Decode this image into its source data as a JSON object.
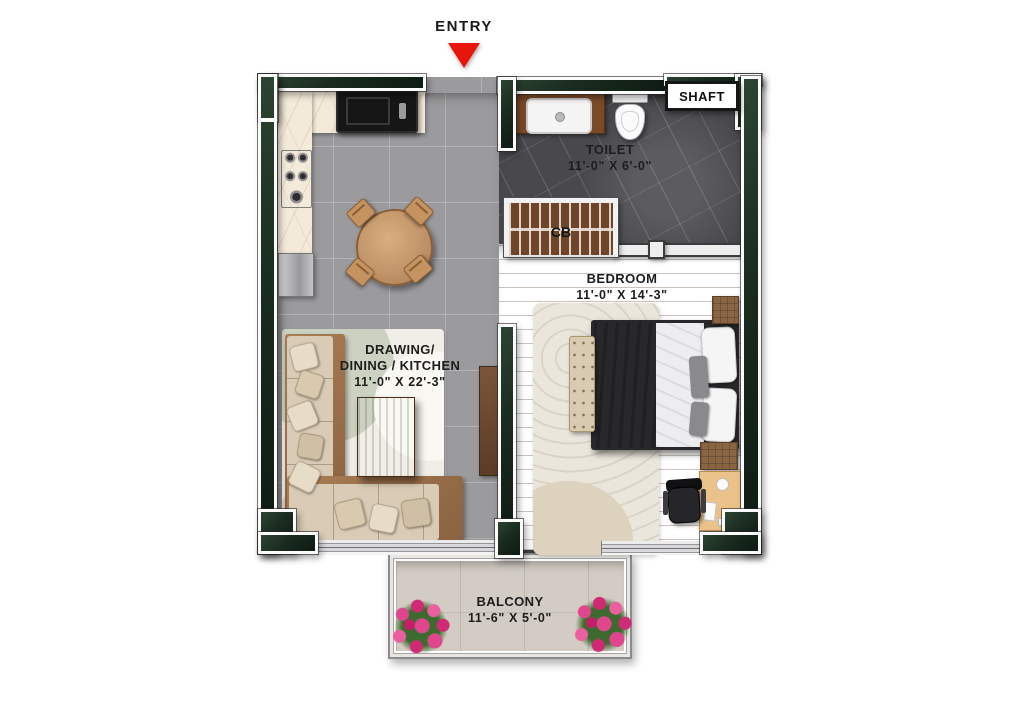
{
  "plan": {
    "title": "apartment-floor-plan",
    "entry": {
      "label": "ENTRY"
    },
    "shaft": {
      "label": "SHAFT"
    },
    "wardrobe": {
      "label": "CB"
    },
    "rooms": {
      "toilet": {
        "name": "TOILET",
        "dims": "11'-0\" X 6'-0\""
      },
      "bedroom": {
        "name": "BEDROOM",
        "dims": "11'-0\" X 14'-3\""
      },
      "drawing": {
        "line1": "DRAWING/",
        "line2": "DINING / KITCHEN",
        "dims": "11'-0\" X 22'-3\""
      },
      "balcony": {
        "name": "BALCONY",
        "dims": "11'-6\" X 5'-0\""
      }
    },
    "colors": {
      "wall": "#1a2b1f",
      "entry_arrow": "#e8150c",
      "tile_floor": "#9b9b9d",
      "marble_floor": "#49494d",
      "wood_floor": "#b5834f",
      "balcony_floor": "#d2ccc4",
      "counter": "#f3ead9",
      "sofa": "#d9cbb5",
      "flower": "#e0468e"
    }
  }
}
